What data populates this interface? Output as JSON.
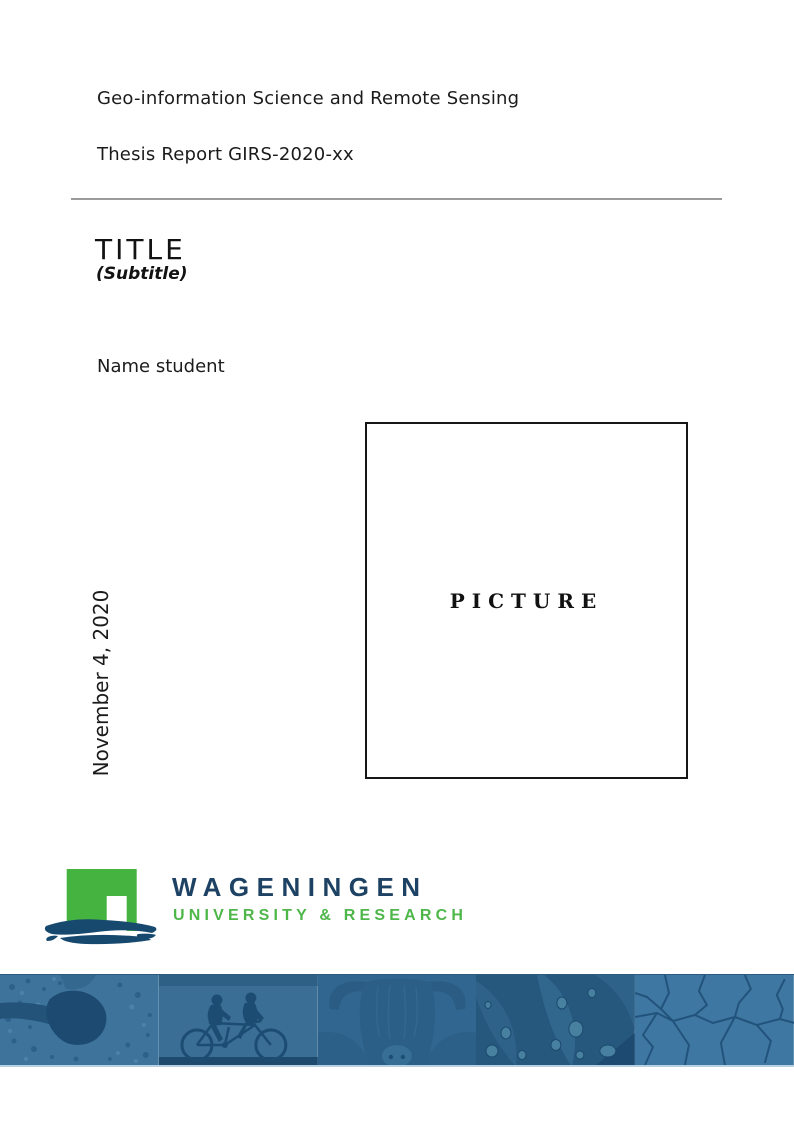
{
  "page": {
    "department": "Geo-information Science and Remote Sensing",
    "report_line": "Thesis Report GIRS-2020-xx",
    "title": "TITLE",
    "subtitle": "(Subtitle)",
    "author": "Name student",
    "date": "November 4, 2020",
    "picture_placeholder": "PICTURE"
  },
  "logo": {
    "name": "WAGENINGEN",
    "tagline": "UNIVERSITY & RESEARCH",
    "mark": "green-gate-over-blue-brushstroke",
    "colors": {
      "green": "#44b340",
      "navy": "#1e4263",
      "brush_navy": "#17496f"
    }
  },
  "divider": {
    "color": "#9b9b9b"
  },
  "banner": {
    "tint_base": "#35688f",
    "segments": [
      {
        "name": "aerial-map-photo"
      },
      {
        "name": "tandem-cyclists-photo"
      },
      {
        "name": "highland-cow-photo"
      },
      {
        "name": "leaf-droplets-photo"
      },
      {
        "name": "cracked-earth-photo"
      }
    ]
  }
}
